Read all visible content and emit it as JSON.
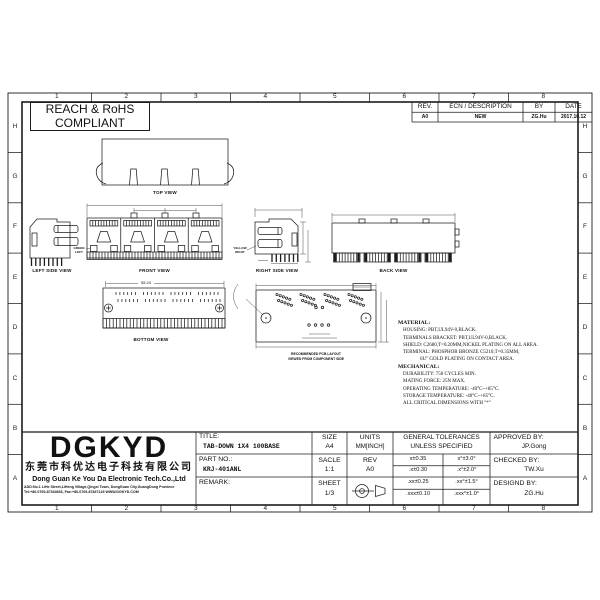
{
  "sheet": {
    "compliance_line1": "REACH & RoHS",
    "compliance_line2": "COMPLIANT",
    "rev_table": {
      "headers": [
        "REV.",
        "ECN / DESCRIPTION",
        "BY",
        "DATE"
      ],
      "row": {
        "rev": "A0",
        "description": "NEW",
        "by": "ZG.Hu",
        "date": "2017.10.12"
      }
    },
    "border": {
      "columns": [
        "1",
        "2",
        "3",
        "4",
        "5",
        "6",
        "7",
        "8"
      ],
      "rows": [
        "H",
        "G",
        "F",
        "E",
        "D",
        "C",
        "B",
        "A"
      ]
    }
  },
  "views": {
    "top_label": "TOP VIEW",
    "left_label": "LEFT SIDE VIEW",
    "front_label": "FRONT VIEW",
    "right_label": "RIGHT SIDE VIEW",
    "back_label": "BACK VIEW",
    "bottom_label": "BOTTOM VIEW",
    "pcb_caption1": "RECOMMENDED PCB LAYOUT",
    "pcb_caption2": "VIEWED FROM COMPONENT SIDE",
    "green_led_label1": "GREEN",
    "green_led_label2": "LEFT",
    "yellow_led_label1": "YELLOW",
    "yellow_led_label2": "RIGHT",
    "bottom_overall_dim": "55.24"
  },
  "notes": {
    "material_title": "MATERIAL:",
    "material_lines": [
      "HOUSING: PBT,UL94V-0,BLACK.",
      "TERMINALS BRACKET: PBT,UL94V-0,BLACK.",
      "SHIELD: C2680,T=0.20MM,NICKEL PLATING ON ALL AREA.",
      "TERMINAL: PHOSPHOR BRONZE C5210,T=0.35MM,",
      "6U\" GOLD PLATING ON CONTACT AREA."
    ],
    "mechanical_title": "MECHANICAL:",
    "mechanical_lines": [
      "DURABILITY: 750 CYCLES MIN.",
      "MATING FORCE: 25N MAX.",
      "OPERATING TEMPERATURE: -40°C~+85°C.",
      "STORAGE TEMPERATURE: -40°C~+85°C.",
      "ALL CRITICAL DIMENSIONS WITH \"*\""
    ]
  },
  "title_block": {
    "logo": "DGKYD",
    "company_cn": "东莞市科优达电子科技有限公司",
    "company_en": "Dong Guan Ke You Da Electronic Tech.Co.,Ltd",
    "address_line1": "ADD:No.1 LiHe Street,LiHeng Village,Qingxi Town, DongGuan City,GuangDong Province",
    "address_line2": "Tel:+86-0769-87334666, Fax:+86-0769-87847129  WWW.DGKYD.COM",
    "title_label": "TITLE:",
    "title_value": "TAB-DOWN 1X4 100BASE",
    "part_label": "PART NO.:",
    "part_value": "KRJ-401ANL",
    "remark_label": "REMARK:",
    "size_label": "SIZE",
    "size_value": "A4",
    "units_label": "UNITS",
    "units_value": "MM[INCH]",
    "scale_label": "SACLE",
    "scale_value": "1:1",
    "rev_label": "REV",
    "rev_value": "A0",
    "sheet_label": "SHEET",
    "sheet_value": "1/3",
    "tol_header_line1": "GENERAL TOLERANCES",
    "tol_header_line2": "UNLESS SPECIFIED",
    "tolerances": [
      [
        "x±0.35",
        "x°±3.0°"
      ],
      [
        ".x±0.30",
        ".x°±2.0°"
      ],
      [
        ".xx±0.25",
        ".xx°±1.5°"
      ],
      [
        ".xxx±0.10",
        ".xxx°±1.0°"
      ]
    ],
    "approved_label": "APPROVED BY:",
    "approved_value": "JP.Gong",
    "checked_label": "CHECKED BY:",
    "checked_value": "TW.Xu",
    "designed_label": "DESIGND BY:",
    "designed_value": "ZG.Hu"
  },
  "colors": {
    "led_green": "#00c300",
    "led_yellow": "#ffd800",
    "line": "#1c1c1c"
  }
}
